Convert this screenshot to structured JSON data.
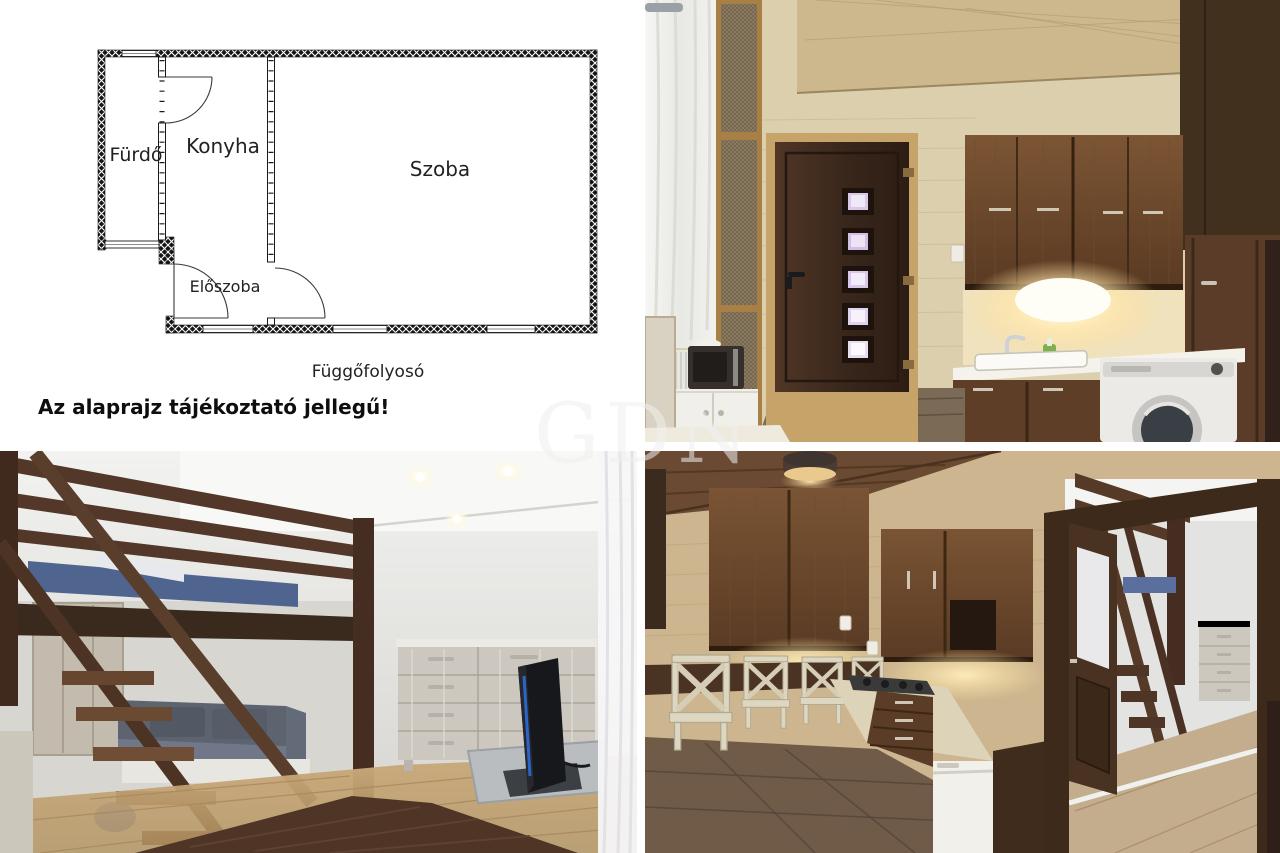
{
  "watermark": {
    "text": "GDN"
  },
  "floor_plan": {
    "rooms": {
      "bathroom": "Fürdő",
      "kitchen": "Konyha",
      "room": "Szoba",
      "hall": "Előszoba"
    },
    "corridor_label": "Függőfolyosó",
    "disclaimer": "Az alaprajz tájékoztató jellegű!"
  },
  "colors": {
    "plan_line": "#1a1a1a",
    "wall_hatch": "#111111",
    "birch_wall": "#d8c9a8",
    "walnut_cabinet": "#6f4c30",
    "dark_door": "#3d2b20",
    "loft_wood": "#53382a",
    "mattress_blue": "#4f648f",
    "warm_light": "#ffe9b8",
    "dresser_gray": "#ccc8bf",
    "floor_oak": "#c0a176",
    "watermark_gray": "#eeeeee"
  }
}
